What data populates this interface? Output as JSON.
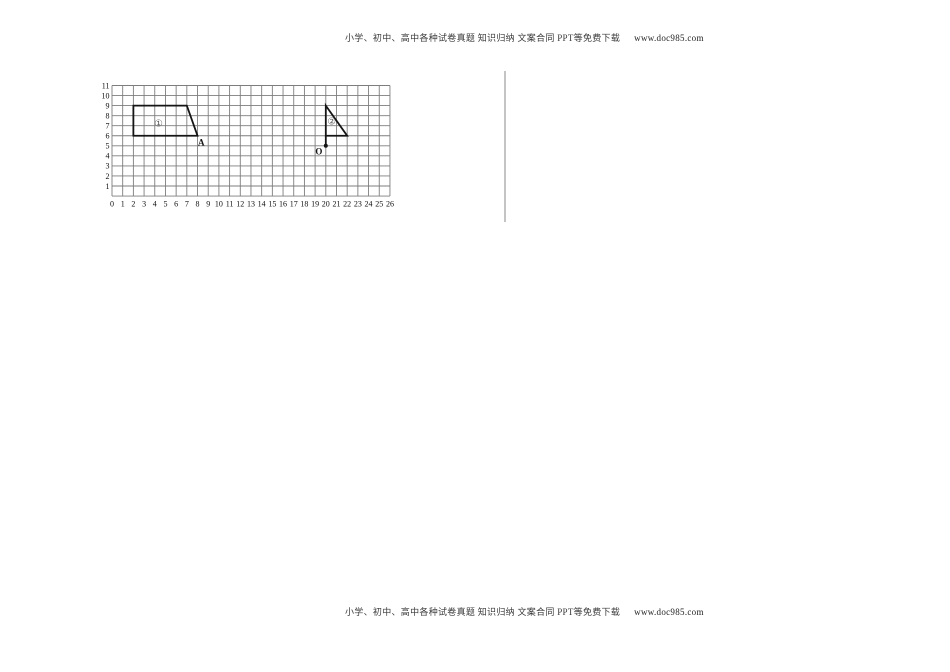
{
  "header": {
    "text": "小学、初中、高中各种试卷真题 知识归纳 文案合同 PPT等免费下载",
    "link": "www.doc985.com"
  },
  "footer": {
    "text": "小学、初中、高中各种试卷真题 知识归纳 文案合同 PPT等免费下载",
    "link": "www.doc985.com"
  },
  "colors": {
    "grid_line": "#7d7d7d",
    "shape_line": "#141414",
    "axis_text": "#111111",
    "shape_label": "#5a5a5a",
    "divider": "#c4c4c4",
    "page_bg": "#ffffff"
  },
  "chart_data": {
    "type": "grid-geometry",
    "title": "",
    "x_range": [
      0,
      26
    ],
    "y_range": [
      0,
      11
    ],
    "grid": true,
    "x_tick_labels": [
      "0",
      "1",
      "2",
      "3",
      "4",
      "5",
      "6",
      "7",
      "8",
      "9",
      "10",
      "11",
      "12",
      "13",
      "14",
      "15",
      "16",
      "17",
      "18",
      "19",
      "20",
      "21",
      "22",
      "23",
      "24",
      "25",
      "26"
    ],
    "y_tick_labels": [
      "1",
      "2",
      "3",
      "4",
      "5",
      "6",
      "7",
      "8",
      "9",
      "10",
      "11"
    ],
    "shapes": [
      {
        "name": "trapezoid-shape-1",
        "label": "①",
        "label_pos": [
          4.35,
          7.25
        ],
        "points": [
          [
            2,
            9
          ],
          [
            7,
            9
          ],
          [
            8,
            6
          ],
          [
            2,
            6
          ]
        ],
        "closed": true
      },
      {
        "name": "triangle-shape-2",
        "label": "②",
        "label_pos": [
          20.55,
          7.45
        ],
        "points": [
          [
            20,
            9
          ],
          [
            22,
            6
          ],
          [
            20,
            6
          ]
        ],
        "closed": true
      }
    ],
    "segments": [
      {
        "name": "triangle-stem-segment",
        "from": [
          20,
          6
        ],
        "to": [
          20,
          5
        ]
      }
    ],
    "marked_points": [
      {
        "label": "A",
        "at": [
          8,
          6
        ],
        "label_pos": [
          8.35,
          5.35
        ],
        "dot": false
      },
      {
        "label": "O",
        "at": [
          20,
          5
        ],
        "label_pos": [
          19.35,
          4.45
        ],
        "dot": true
      }
    ]
  }
}
